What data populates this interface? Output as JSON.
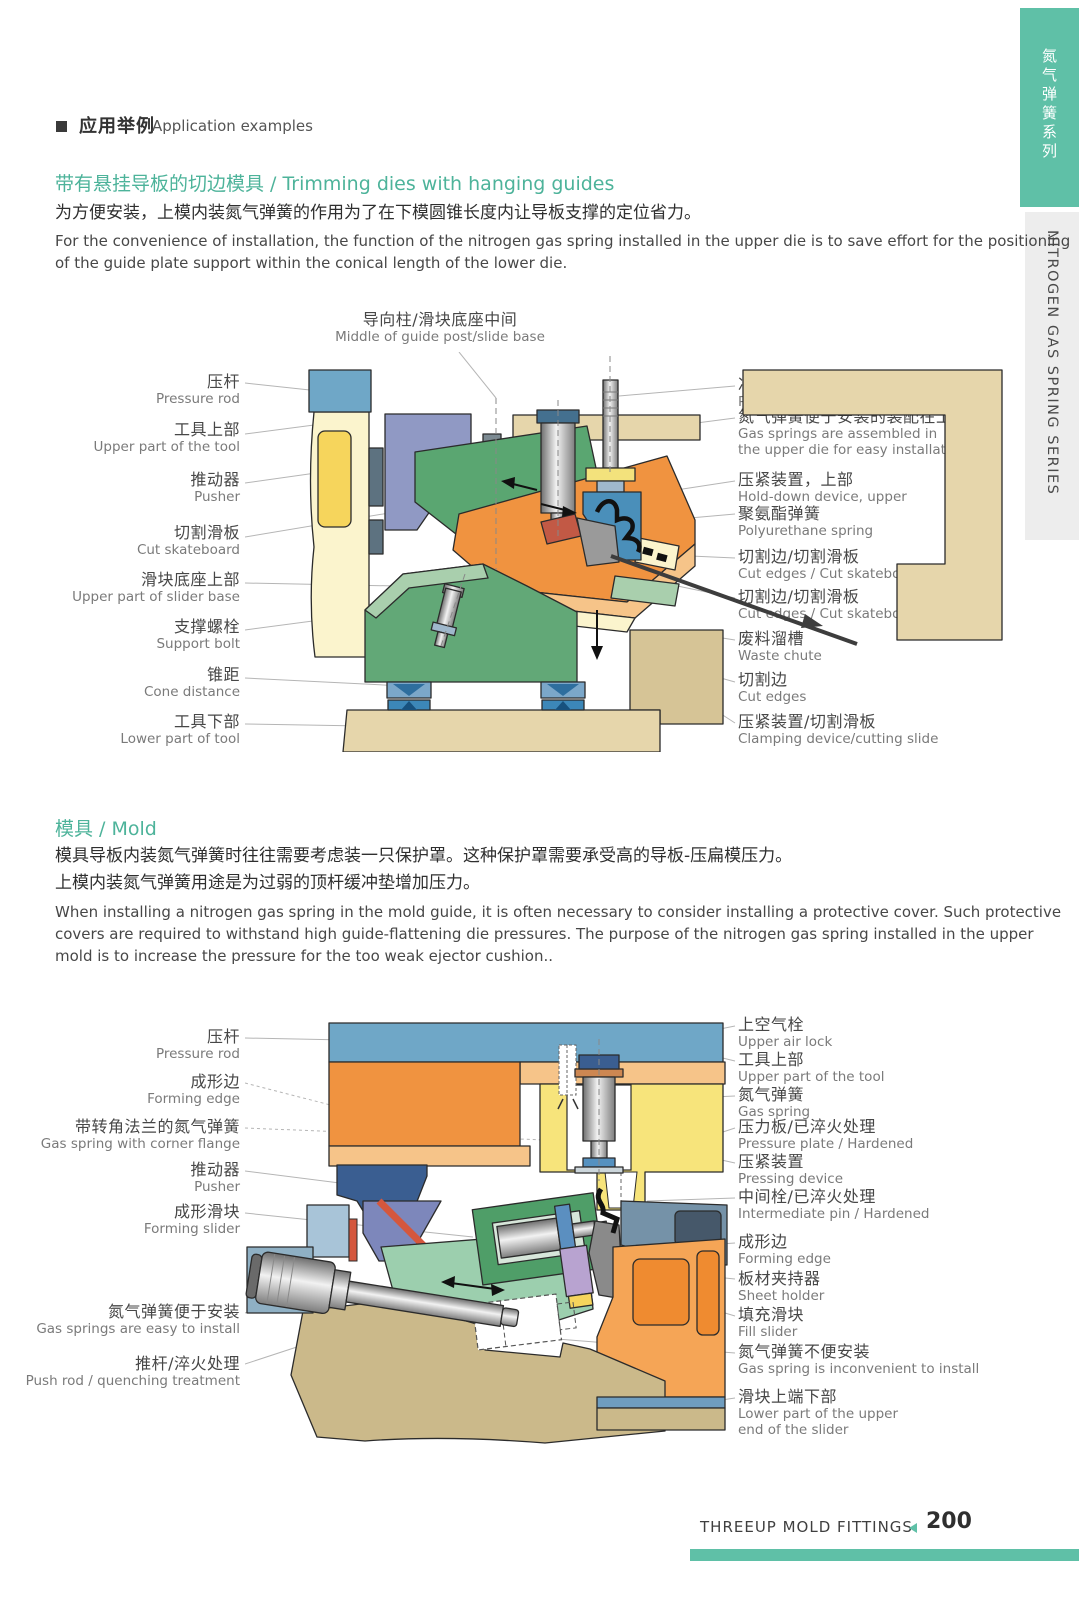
{
  "header": {
    "title_zh": "应用举例",
    "title_en": "Application examples"
  },
  "sidebar": {
    "series_zh": "氮气弹簧系列",
    "series_en": "NITROGEN GAS SPRING SERIES",
    "accent_color": "#5fc0a7"
  },
  "section1": {
    "title": "带有悬挂导板的切边模具 / Trimming dies with hanging guides",
    "body_zh": "为方便安装，上模内装氮气弹簧的作用为了在下模圆锥长度内让导板支撑的定位省力。",
    "body_en": "For the convenience of installation, the function of the nitrogen gas spring installed in the upper die is to save effort for the positioning\nof the guide plate support within the conical length of the lower die."
  },
  "diagram1": {
    "top_label": {
      "zh": "导向柱/滑块底座中间",
      "en": "Middle of guide post/slide base"
    },
    "left_labels": [
      {
        "zh": "压杆",
        "en": "Pressure rod"
      },
      {
        "zh": "工具上部",
        "en": "Upper part of the tool"
      },
      {
        "zh": "推动器",
        "en": "Pusher"
      },
      {
        "zh": "切割滑板",
        "en": "Cut skateboard"
      },
      {
        "zh": "滑块底座上部",
        "en": "Upper part of slider base"
      },
      {
        "zh": "支撑螺栓",
        "en": "Support bolt"
      },
      {
        "zh": "锥距",
        "en": "Cone distance"
      },
      {
        "zh": "工具下部",
        "en": "Lower part of tool"
      }
    ],
    "right_labels": [
      {
        "zh": "冲杆垫螺栓",
        "en": "Punch pad bolt"
      },
      {
        "zh": "氮气弹簧便于安装的装配在上模中",
        "en": "Gas springs are assembled in\nthe upper die for easy installation"
      },
      {
        "zh": "压紧装置，上部",
        "en": "Hold-down device, upper"
      },
      {
        "zh": "聚氨酯弹簧",
        "en": "Polyurethane spring"
      },
      {
        "zh": "切割边/切割滑板",
        "en": "Cut edges / Cut skateboards"
      },
      {
        "zh": "切割边/切割滑板",
        "en": "Cut edges / Cut skateboards"
      },
      {
        "zh": "废料溜槽",
        "en": "Waste chute"
      },
      {
        "zh": "切割边",
        "en": "Cut edges"
      },
      {
        "zh": "压紧装置/切割滑板",
        "en": "Clamping device/cutting slide"
      }
    ]
  },
  "section2": {
    "title": "模具 / Mold",
    "body_zh": "模具导板内装氮气弹簧时往往需要考虑装一只保护罩。这种保护罩需要承受高的导板-压扁模压力。\n上模内装氮气弹簧用途是为过弱的顶杆缓冲垫增加压力。",
    "body_en": "When installing a nitrogen gas spring in the mold guide, it is often necessary to consider installing a protective cover. Such protective\ncovers are required to withstand high guide-flattening die pressures. The purpose of the nitrogen gas spring installed in the upper\nmold is to increase the pressure for the too weak ejector cushion.."
  },
  "diagram2": {
    "left_labels": [
      {
        "zh": "压杆",
        "en": "Pressure rod"
      },
      {
        "zh": "成形边",
        "en": "Forming edge"
      },
      {
        "zh": "带转角法兰的氮气弹簧",
        "en": "Gas spring with corner flange"
      },
      {
        "zh": "推动器",
        "en": "Pusher"
      },
      {
        "zh": "成形滑块",
        "en": "Forming slider"
      },
      {
        "zh": "氮气弹簧便于安装",
        "en": "Gas springs are easy to install"
      },
      {
        "zh": "推杆/淬火处理",
        "en": "Push rod / quenching treatment"
      }
    ],
    "right_labels": [
      {
        "zh": "上空气栓",
        "en": "Upper air lock"
      },
      {
        "zh": "工具上部",
        "en": "Upper part of the tool"
      },
      {
        "zh": "氮气弹簧",
        "en": "Gas spring"
      },
      {
        "zh": "压力板/已淬火处理",
        "en": "Pressure plate / Hardened"
      },
      {
        "zh": "压紧装置",
        "en": "Pressing device"
      },
      {
        "zh": "中间栓/已淬火处理",
        "en": "Intermediate pin / Hardened"
      },
      {
        "zh": "成形边",
        "en": "Forming edge"
      },
      {
        "zh": "板材夹持器",
        "en": "Sheet holder"
      },
      {
        "zh": "填充滑块",
        "en": "Fill slider"
      },
      {
        "zh": "氮气弹簧不便安装",
        "en": "Gas spring is inconvenient to install"
      },
      {
        "zh": "滑块上端下部",
        "en": "Lower part of the upper\nend of the slider"
      }
    ]
  },
  "footer": {
    "brand": "THREEUP MOLD FITTINGS",
    "page_number": "200"
  }
}
